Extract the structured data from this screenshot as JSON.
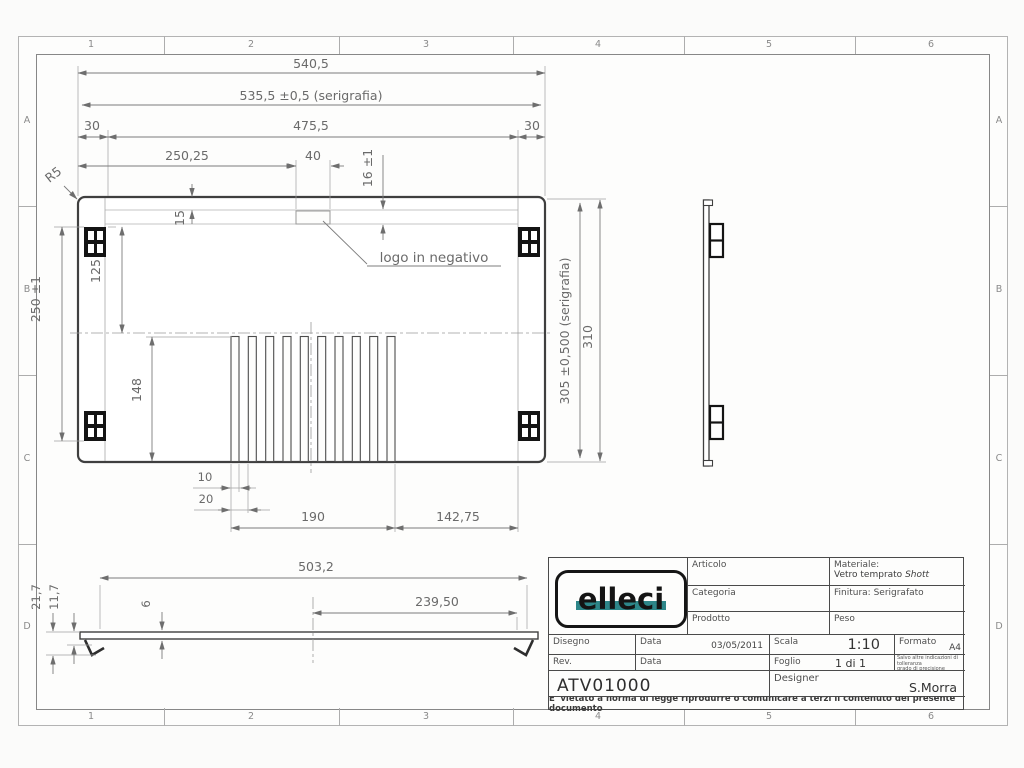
{
  "grid": {
    "cols": [
      "1",
      "2",
      "3",
      "4",
      "5",
      "6"
    ],
    "rows": [
      "A",
      "B",
      "C",
      "D"
    ]
  },
  "dims": {
    "w_total": "540,5",
    "w_serig": "535,5 ±0,5  (serigrafia)",
    "m_left": "30",
    "w_inner": "475,5",
    "m_right": "30",
    "logo_x": "250,25",
    "logo_w": "40",
    "band_h": "16 ±1",
    "band_top": "15",
    "r_corner": "R5",
    "pad_span": "250 ±1",
    "pad_half": "125",
    "slot_h": "148",
    "h_serig": "305 ±0,500 (serigrafia)",
    "h_total": "310",
    "slot_w": "10",
    "slot_pitch": "20",
    "slot_field": "190",
    "slot_right": "142,75",
    "logo_note": "logo in negativo",
    "sec_len": "503,2",
    "sec_half": "239,50",
    "sec_h1": "21,7",
    "sec_h2": "11,7",
    "sec_t": "6"
  },
  "title_block": {
    "logo_text": "elleci",
    "articolo_label": "Articolo",
    "categoria_label": "Categoria",
    "prodotto_label": "Prodotto",
    "materiale_label": "Materiale:",
    "materiale_value": "Vetro temprato",
    "materiale_value_italic": "Shott",
    "finitura_label": "Finitura: Serigrafato",
    "peso_label": "Peso",
    "disegno_label": "Disegno",
    "data1_label": "Data",
    "data1_value": "03/05/2011",
    "scala_label": "Scala",
    "scala_value": "1:10",
    "formato_label": "Formato",
    "formato_value": "A4",
    "rev_label": "Rev.",
    "data2_label": "Data",
    "foglio_label": "Foglio",
    "foglio_value": "1 di 1",
    "tolerance_note_1": "Salvo altre indicazioni di tolleranza",
    "tolerance_note_2": "grado di precisione UNI5307",
    "code": "ATV01000",
    "designer_label": "Designer",
    "designer_value": "S.Morra",
    "disclaimer": "E' vietato a norma di legge riprodurre o comunicare a terzi il contenuto del presente documento"
  },
  "colors": {
    "logo_teal": "#2d8689",
    "edge_line": "#3f3f3f",
    "dim_line": "#7c7c7c"
  }
}
